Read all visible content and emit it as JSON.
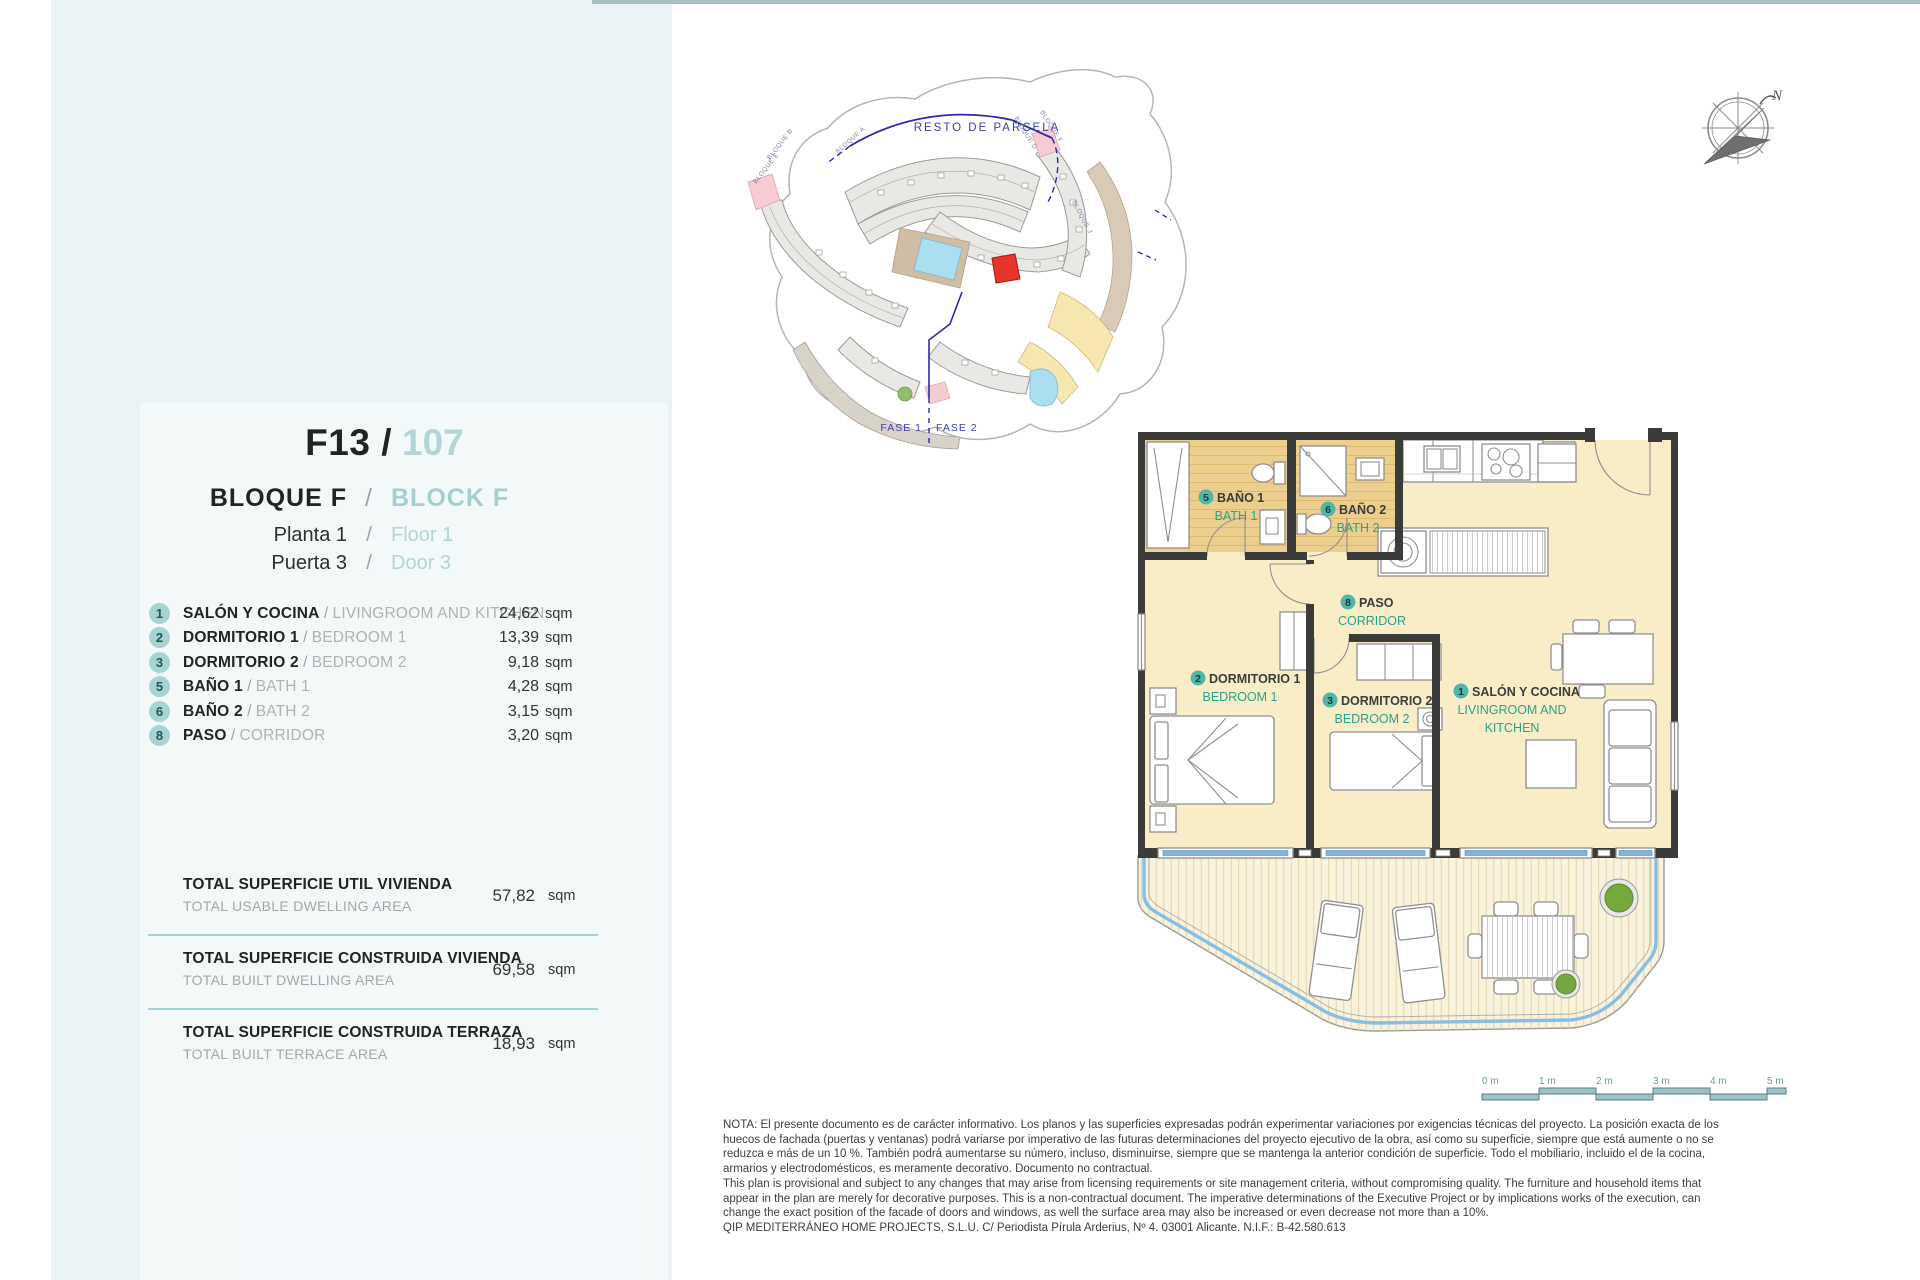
{
  "colors": {
    "accent_teal": "#45b1a2",
    "light_teal_text": "#a9d0d3",
    "plan_green": "#2aa28c",
    "red_unit": "#e8352a",
    "navy": "#2a2aa8",
    "window_blue": "#7db5dd",
    "left_background": "#e9f3f5"
  },
  "header": {
    "title": {
      "code": "F13 /",
      "number": "107"
    },
    "block": {
      "es": "BLOQUE  F",
      "sep": "/",
      "en": "BLOCK  F"
    },
    "floor": {
      "es": "Planta 1",
      "sep": "/",
      "en": "Floor   1"
    },
    "door": {
      "es": "Puerta 3",
      "sep": "/",
      "en": "Door   3"
    }
  },
  "rooms": [
    {
      "num": "1",
      "es": "SALÓN Y COCINA",
      "sep": " / ",
      "en": "LIVINGROOM AND KITCHEN",
      "value": "24,62",
      "unit": "sqm"
    },
    {
      "num": "2",
      "es": "DORMITORIO 1",
      "sep": " / ",
      "en": "BEDROOM 1",
      "value": "13,39",
      "unit": "sqm"
    },
    {
      "num": "3",
      "es": "DORMITORIO 2",
      "sep": " / ",
      "en": "BEDROOM 2",
      "value": "9,18",
      "unit": "sqm"
    },
    {
      "num": "5",
      "es": "BAÑO 1",
      "sep": " / ",
      "en": "BATH 1",
      "value": "4,28",
      "unit": "sqm"
    },
    {
      "num": "6",
      "es": "BAÑO 2",
      "sep": " / ",
      "en": "BATH 2",
      "value": "3,15",
      "unit": "sqm"
    },
    {
      "num": "8",
      "es": "PASO",
      "sep": " / ",
      "en": "CORRIDOR",
      "value": "3,20",
      "unit": "sqm"
    }
  ],
  "totals": [
    {
      "es": "TOTAL SUPERFICIE UTIL VIVIENDA",
      "en": "TOTAL USABLE DWELLING AREA",
      "value": "57,82",
      "unit": "sqm"
    },
    {
      "es": "TOTAL SUPERFICIE CONSTRUIDA VIVIENDA",
      "en": "TOTAL BUILT DWELLING AREA",
      "value": "69,58",
      "unit": "sqm"
    },
    {
      "es": "TOTAL SUPERFICIE CONSTRUIDA TERRAZA",
      "en": "TOTAL BUILT TERRACE AREA",
      "value": "18,93",
      "unit": "sqm"
    }
  ],
  "plan": {
    "salon": {
      "num": "1",
      "es": "SALÓN Y COCINA",
      "en1": "LIVINGROOM AND",
      "en2": "KITCHEN"
    },
    "bed1": {
      "num": "2",
      "es": "DORMITORIO 1",
      "en": "BEDROOM 1"
    },
    "bed2": {
      "num": "3",
      "es": "DORMITORIO 2",
      "en": "BEDROOM 2"
    },
    "bath1": {
      "num": "5",
      "es": "BAÑO 1",
      "en": "BATH 1"
    },
    "bath2": {
      "num": "6",
      "es": "BAÑO 2",
      "en": "BATH 2"
    },
    "corridor": {
      "num": "8",
      "es": "PASO",
      "en": "CORRIDOR"
    }
  },
  "site": {
    "resto": "RESTO DE PARCELA",
    "fase1": "FASE 1",
    "fase2": "FASE 2",
    "bloques": [
      "BLOQUE B",
      "BLOQUE E",
      "BLOQUE A",
      "BLOQUE D",
      "BLOQUE F",
      "BLOQUE J"
    ]
  },
  "compass": {
    "north": "N"
  },
  "scale": {
    "labels": [
      "0 m",
      "1 m",
      "2 m",
      "3 m",
      "4 m",
      "5 m"
    ]
  },
  "note": {
    "lines": [
      "NOTA: El presente documento es de carácter informativo. Los planos y las superficies expresadas podrán experimentar variaciones por exigencias técnicas del proyecto. La posición exacta de los",
      "huecos de fachada (puertas y ventanas) podrá variarse por imperativo de las futuras determinaciones del proyecto ejecutivo de la obra, así como su superficie, siempre que está aumente o no se",
      "reduzca e más de un 10 %. También podrá aumentarse su número, incluso, disminuirse, siempre que se mantenga la anterior condición de superficie. Todo el mobiliario, incluido el de la cocina,",
      "armarios y electrodomésticos, es meramente decorativo. Documento no contractual.",
      "This plan is provisional and subject to any changes that may arise from licensing requirements or site management criteria, without compromising quality. The furniture and household items that",
      "appear in the plan are merely for decorative purposes. This is a non-contractual document. The imperative determinations of the Executive Project or by implications works of the execution, can",
      "change the exact position of the facade of doors and windows, as well the surface area may also be increased or even decrease not more than a 10%.",
      "QIP MEDITERRÁNEO HOME PROJECTS, S.L.U. C/ Periodista Pírula Arderius, Nº 4. 03001 Alicante. N.I.F.: B-42.580.613"
    ]
  }
}
